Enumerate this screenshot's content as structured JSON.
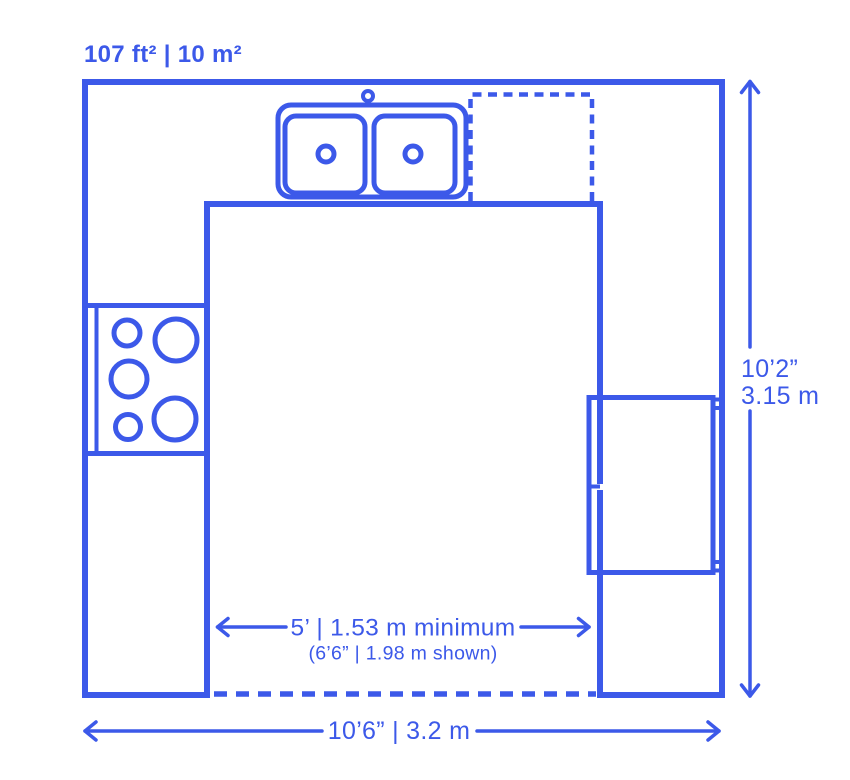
{
  "colors": {
    "accent": "#3C59E9",
    "background": "#FFFFFF"
  },
  "header": {
    "area_label": "107 ft² | 10 m²"
  },
  "dimensions": {
    "overall_height": {
      "imperial": "10’2”",
      "metric": "3.15 m"
    },
    "overall_width": "10’6” | 3.2 m",
    "aisle_clearance": {
      "minimum": "5’ | 1.53 m minimum",
      "shown": "(6’6” | 1.98 m shown)"
    }
  },
  "fixtures": {
    "sink": "double-basin-sink",
    "faucet": "faucet",
    "dishwasher": "dishwasher-dashed-outline",
    "cooktop": "five-burner-cooktop",
    "refrigerator": "refrigerator"
  }
}
